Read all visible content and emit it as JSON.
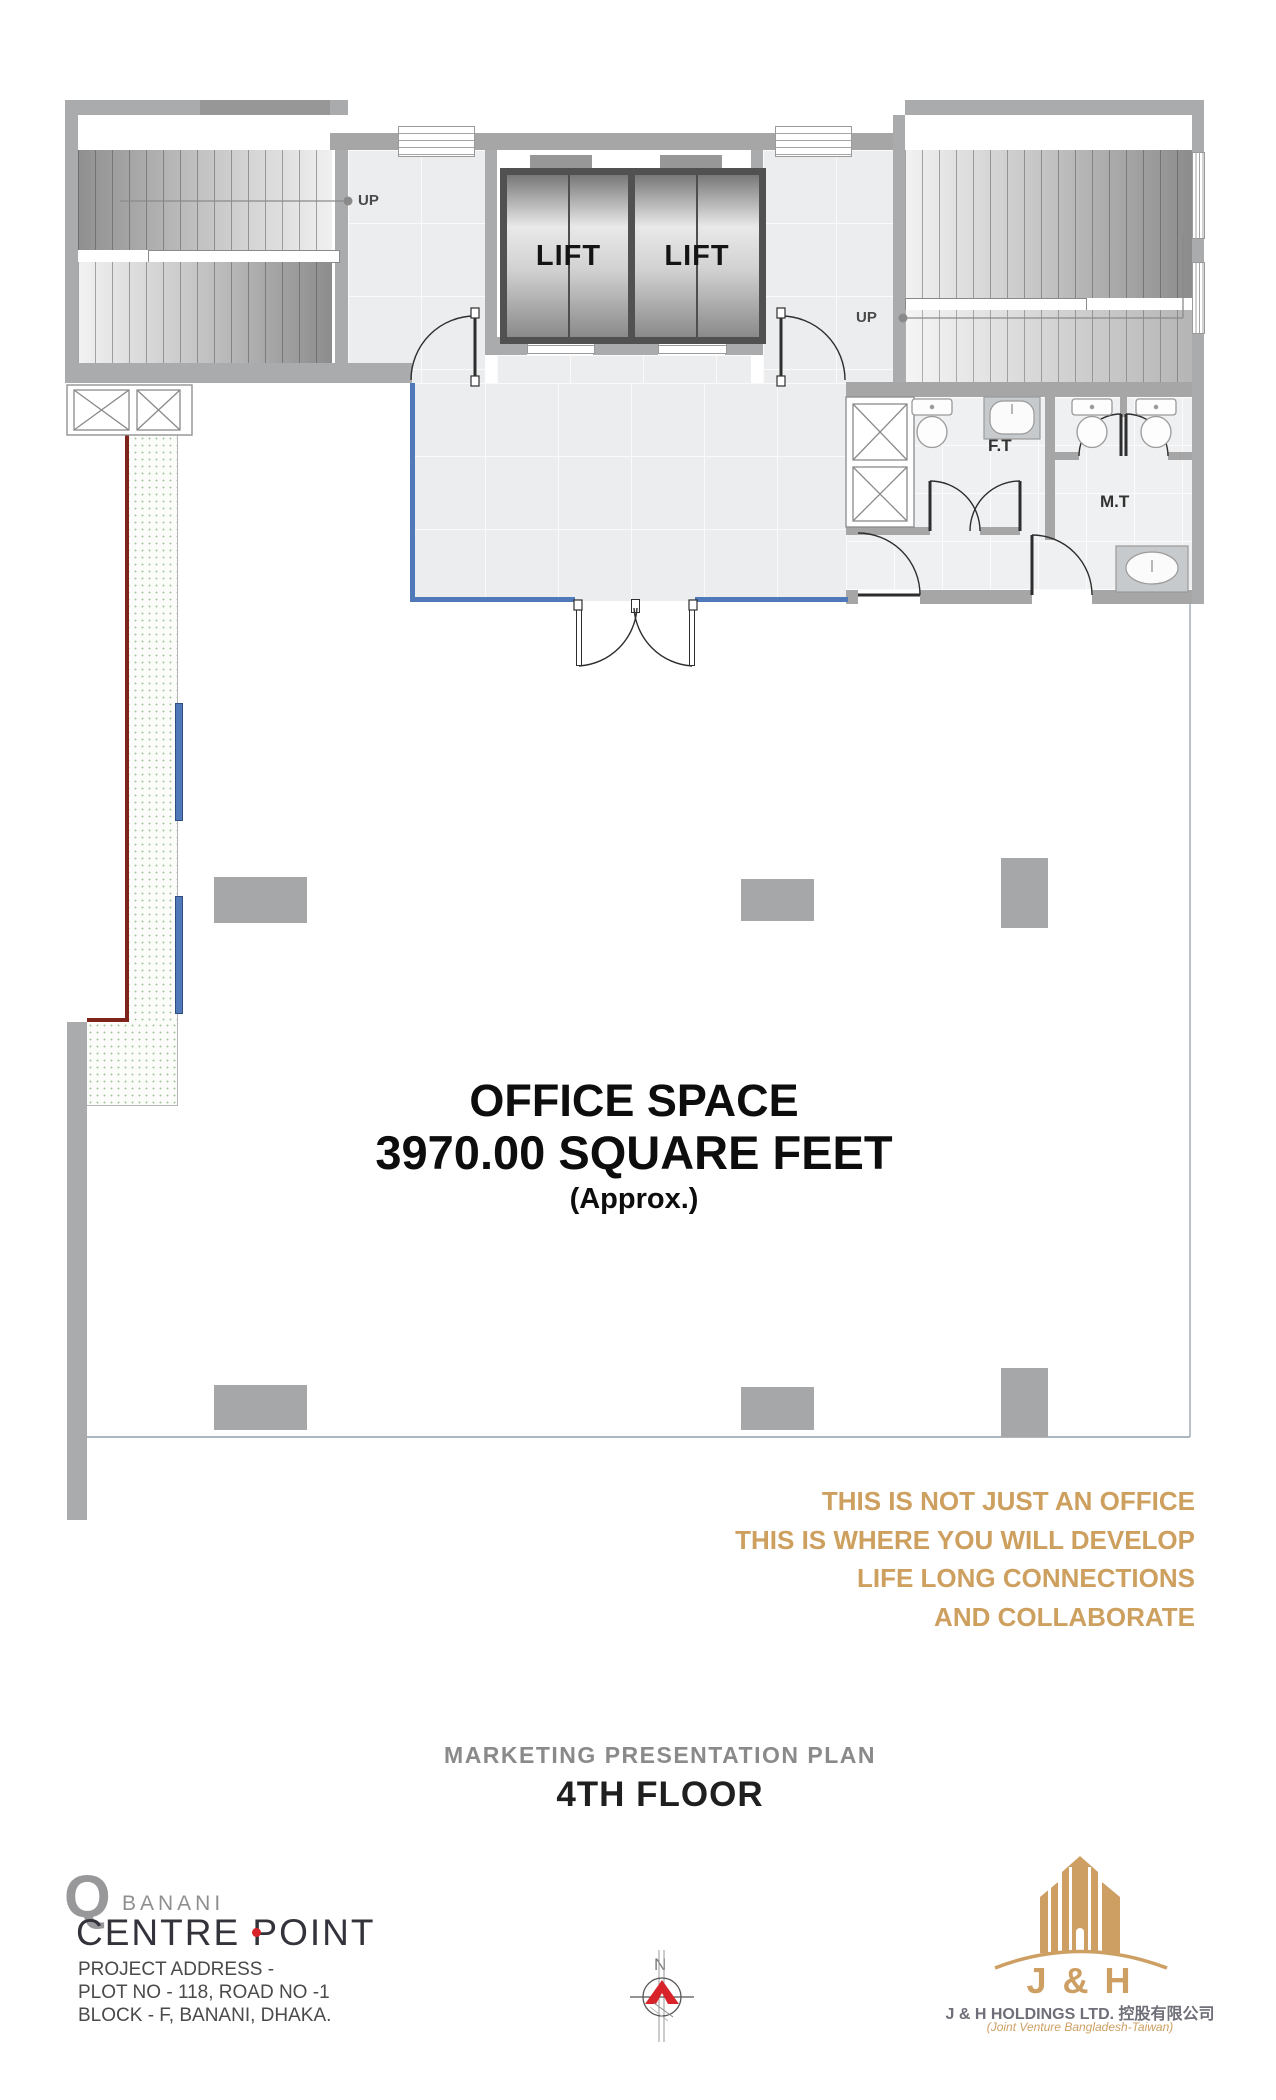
{
  "plan": {
    "stair_left_up": "UP",
    "stair_right_up": "UP",
    "lift_left": "LIFT",
    "lift_right": "LIFT",
    "female_toilet": "F.T",
    "male_toilet": "M.T",
    "office": {
      "name": "OFFICE SPACE",
      "area": "3970.00 SQUARE FEET",
      "approx": "(Approx.)"
    }
  },
  "tagline": {
    "lines": [
      "THIS IS NOT JUST AN OFFICE",
      "THIS IS WHERE YOU WILL DEVELOP",
      "LIFE LONG CONNECTIONS",
      "AND COLLABORATE"
    ]
  },
  "title_block": {
    "plan_type": "MARKETING PRESENTATION PLAN",
    "floor": "4TH FLOOR"
  },
  "developer": {
    "mark": "Q",
    "brand_prefix": "BANANI",
    "brand_name": "CENTRE POINT",
    "address1": "PROJECT ADDRESS -",
    "address2": "PLOT NO - 118, ROAD NO -1",
    "address3": "BLOCK - F, BANANI, DHAKA."
  },
  "company": {
    "monogram": "J & H",
    "name": "J & H HOLDINGS LTD. 控股有限公司",
    "subname": "(Joint Venture Bangladesh-Taiwan)"
  },
  "compass": {
    "label": "N"
  },
  "colors": {
    "gold": "#CEA05F",
    "blue": "#4F79B8",
    "red": "#7E241B"
  }
}
